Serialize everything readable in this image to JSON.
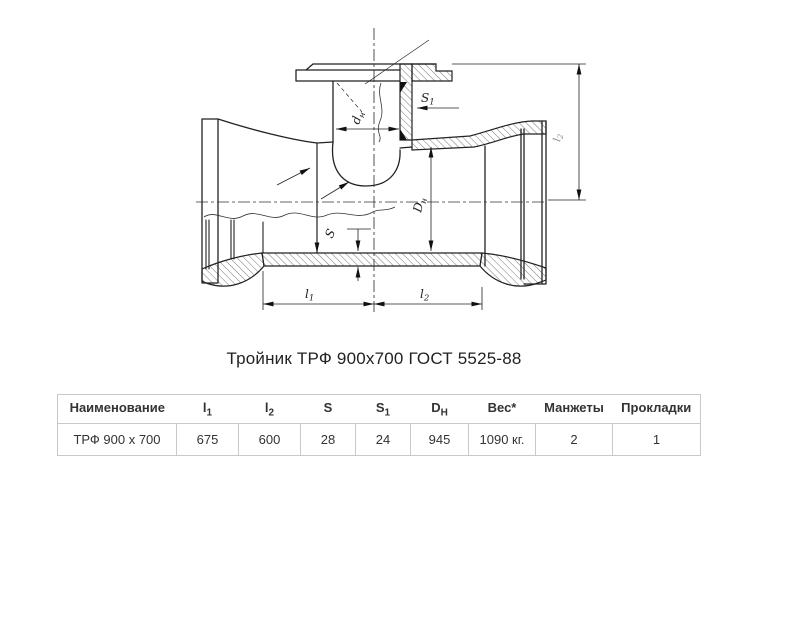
{
  "title": "Тройник ТРФ 900х700 ГОСТ 5525-88",
  "drawing": {
    "labels": {
      "s1": {
        "main": "S",
        "sub": "1"
      },
      "dn": {
        "main": "d",
        "sub": "н"
      },
      "DN": {
        "main": "D",
        "sub": "н"
      },
      "s": "S",
      "l1": {
        "main": "l",
        "sub": "1"
      },
      "l2": {
        "main": "l",
        "sub": "2"
      },
      "height": {
        "main": "l",
        "sub": "2"
      }
    }
  },
  "table": {
    "headers": [
      {
        "main": "Наименование",
        "sub": ""
      },
      {
        "main": "l",
        "sub": "1"
      },
      {
        "main": "l",
        "sub": "2"
      },
      {
        "main": "S",
        "sub": ""
      },
      {
        "main": "S",
        "sub": "1"
      },
      {
        "main": "D",
        "sub": "Н"
      },
      {
        "main": "Вес*",
        "sub": ""
      },
      {
        "main": "Манжеты",
        "sub": ""
      },
      {
        "main": "Прокладки",
        "sub": ""
      }
    ],
    "rows": [
      [
        "ТРФ 900 х 700",
        "675",
        "600",
        "28",
        "24",
        "945",
        "1090 кг.",
        "2",
        "1"
      ]
    ]
  }
}
